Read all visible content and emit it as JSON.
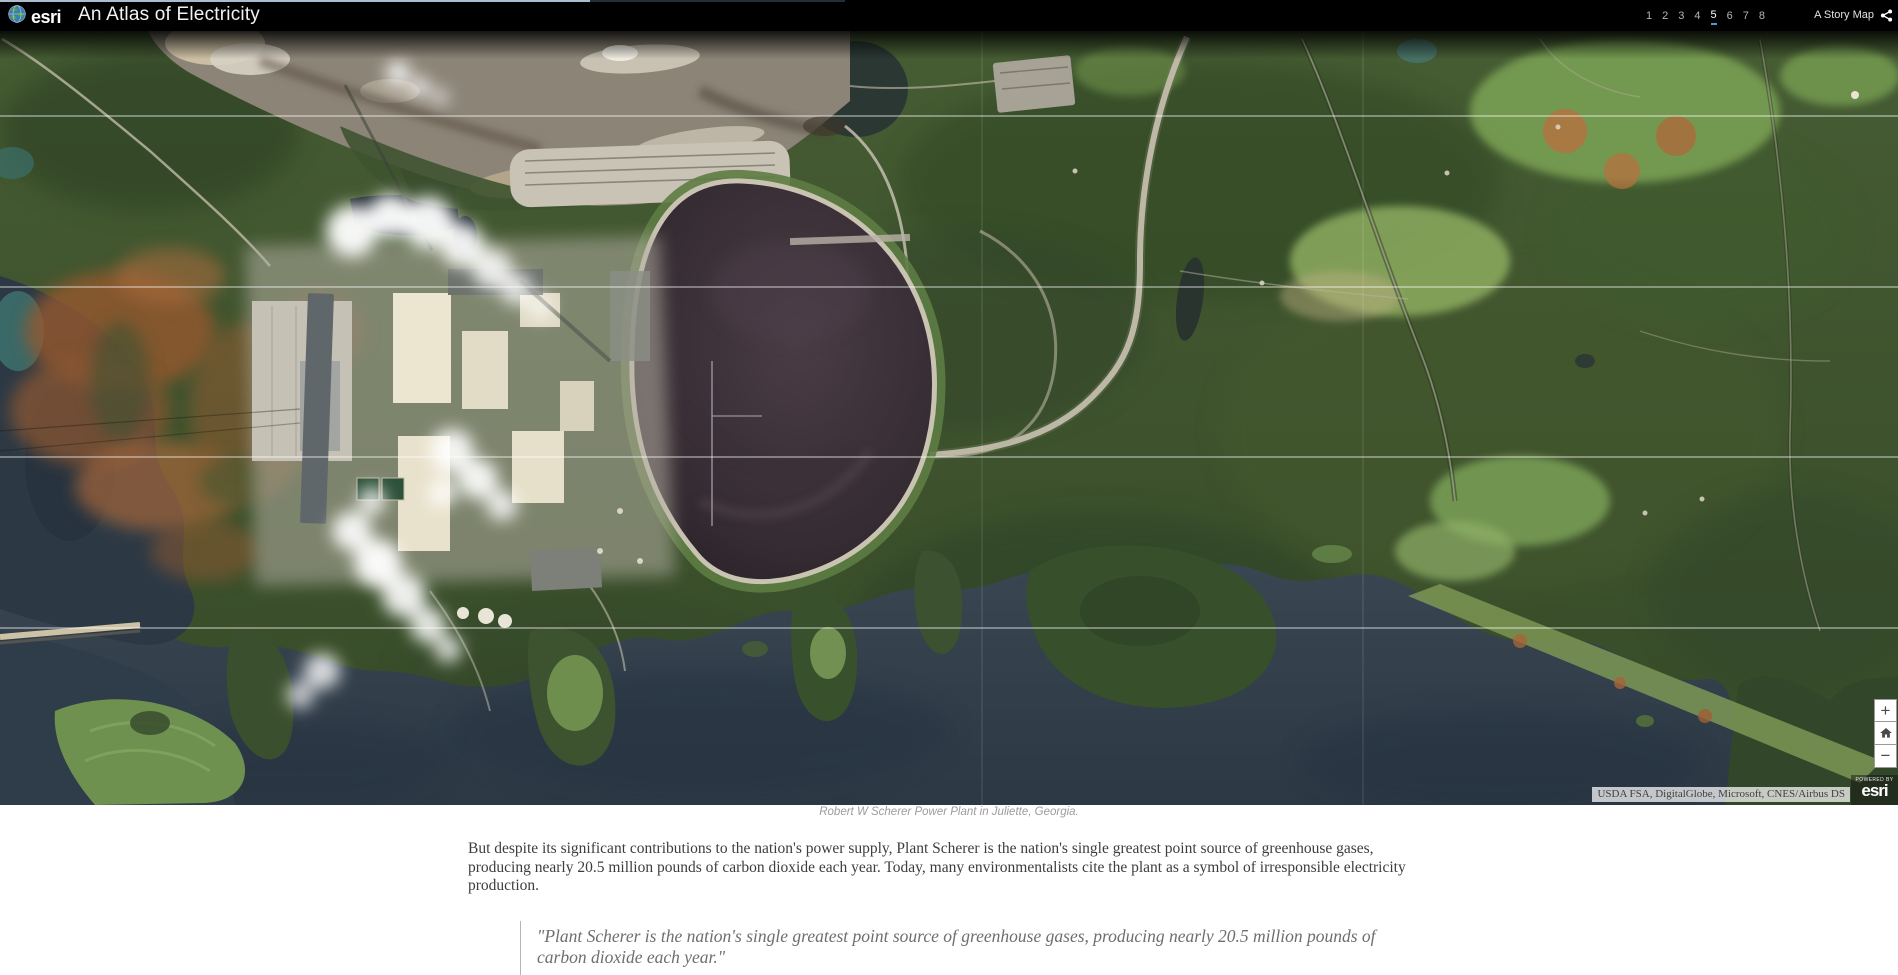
{
  "header": {
    "brand": "esri",
    "title": "An Atlas of Electricity",
    "pages": [
      "1",
      "2",
      "3",
      "4",
      "5",
      "6",
      "7",
      "8"
    ],
    "active_page": "5",
    "story_map_label": "A Story Map"
  },
  "map": {
    "caption": "Robert W Scherer Power Plant in Juliette, Georgia.",
    "attribution": "USDA FSA, DigitalGlobe, Microsoft, CNES/Airbus DS",
    "powered_by": {
      "small": "POWERED BY",
      "brand": "esri"
    },
    "controls": {
      "zoom_in": "+",
      "zoom_out": "−"
    }
  },
  "article": {
    "paragraph": "But despite its significant contributions to the nation's power supply, Plant Scherer is the nation's single greatest point source of greenhouse gases, producing nearly 20.5 million pounds of carbon dioxide each year. Today, many environmentalists cite the plant as a symbol of irresponsible electricity production.",
    "quote": "\"Plant Scherer is the nation's single greatest point source of greenhouse gases, producing nearly 20.5 million pounds of carbon dioxide each year.\""
  },
  "icons": {
    "globe_icon": "esri-globe",
    "share_icon": "share-nodes",
    "home_icon": "house",
    "zoom_in_icon": "plus",
    "zoom_out_icon": "minus"
  },
  "colors": {
    "header_bg": "#000000",
    "active_page_underline": "#4e9bd4",
    "forest": "#3c5029",
    "water": "#33404d",
    "coal_pile": "#332a31",
    "steam": "#ffffff"
  }
}
